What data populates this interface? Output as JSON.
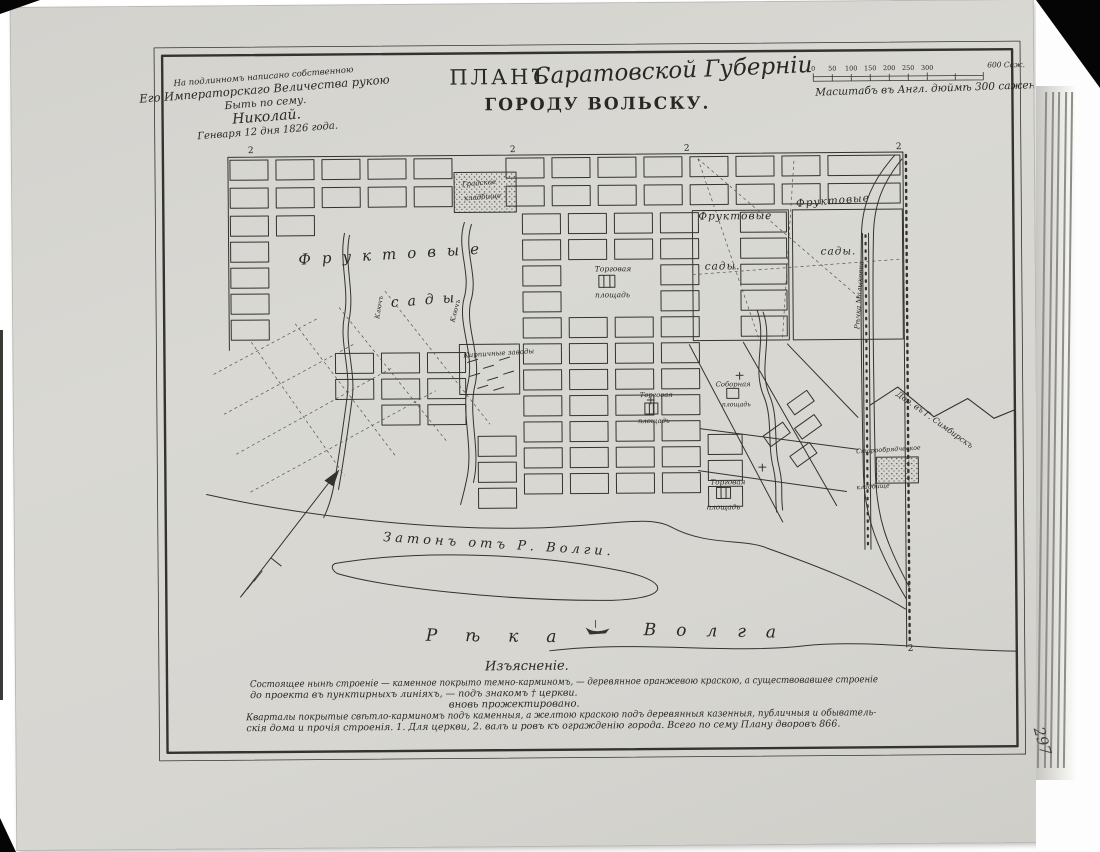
{
  "page": {
    "number": "297"
  },
  "title": {
    "word_plan": "ПЛАНЪ",
    "script_part": "Саратовской Губерніи",
    "line2": "ГОРОДУ ВОЛЬСКУ."
  },
  "imperial_note": {
    "line1": "На подлинномъ написано собственною",
    "line2": "Его Императорскаго Величества рукою",
    "line3": "Быть по сему.",
    "line4": "Николай.",
    "line5": "Генваря 12 дня 1826 года."
  },
  "scale": {
    "ticks": [
      "0",
      "50",
      "100",
      "150",
      "200",
      "250",
      "300"
    ],
    "end_label": "600 Саж.",
    "caption": "Масштабъ въ Англ. дюймѣ 300 саженъ."
  },
  "map": {
    "corner_mark": "2",
    "labels": {
      "orchard_left_word1": "Фруктовые",
      "orchard_left_word2": "сады",
      "orchard_mid_word1": "Фруктовые",
      "orchard_mid_word2": "сады.",
      "orchard_right_word1": "Фруктовые",
      "orchard_right_word2": "сады.",
      "market_upper_line1": "Торговая",
      "market_upper_line2": "площадь",
      "brick_works": "Кирпичные заводы",
      "market_mid_line1": "Торговая",
      "market_mid_line2": "площадь",
      "cathedral_line1": "Соборная",
      "cathedral_line2": "площадь",
      "market_lower_line1": "Торговая",
      "market_lower_line2": "площадь",
      "cemetery_city_line1": "Градское",
      "cemetery_city_line2": "кладбище",
      "cemetery_ob_line1": "Старообрядческое",
      "cemetery_ob_line2": "кладбище",
      "backwater": "Затонъ отъ Р. Волги.",
      "volga_word1": "Рѣка",
      "volga_word2": "Волга",
      "road_simbirsk": "Дор. въ Г. Симбирскъ",
      "spring1": "Ключъ",
      "spring2": "Ключъ",
      "river_malykovka": "Рѣчка Малыковка"
    }
  },
  "legend": {
    "heading": "Изъясненіе.",
    "line1": "Состоящее нынѣ строеніе — каменное покрыто темно-карминомъ, — деревянное оранжевою краскою, а существовавшее строеніе",
    "line2": "до проекта въ пунктирныхъ линіяхъ, — подъ знакомъ † церкви.",
    "line3": "вновь прожектировано.",
    "line4": "Кварталы покрытые свѣтло-карминомъ подъ каменныя, а желтою краскою подъ деревянныя казенныя, публичныя и обыватель-",
    "line5": "скія дома и прочія строенія.   1. Для церкви, 2. валъ и ровъ къ огражденію города. Всего по сему Плану дворовъ 866."
  },
  "colors": {
    "paper": "#d8d7d2",
    "ink": "#2e2d29"
  }
}
